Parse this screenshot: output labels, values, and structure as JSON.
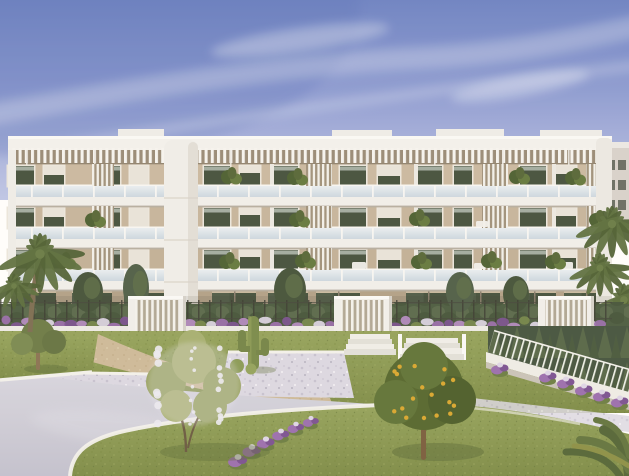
{
  "scene": {
    "type": "architectural exterior render",
    "description": "Golden-hour render of a modern four-storey apartment building with three continuous white balcony bands, glass balustrades, rooftop pergola slats, beige walls with dark glazing, vertical louvre screens and a rounded white stair tower. In front: a cypress hedge with a wire fence, three white slatted entrance gates, garden stairs, raised planters with purple flowers, terraced lawns with white kerbs, a saguaro cactus on a gravel bed, sand and pale-lavender walkways, an olive tree, a white-blossom tree, an orange tree with fruit, palm trees, a picket-railed ramp with conifers, all under a periwinkle sky with wispy clouds",
    "time_of_day": "golden hour",
    "sky": {
      "top": "#6d83c5",
      "mid": "#8d9cd4",
      "horizon": "#bfc7e8",
      "cloud": "#e9edf8"
    },
    "building": {
      "storeys": 4,
      "balcony_bands": 3,
      "entrance_gates": 3,
      "wall_color": "#c6b59e",
      "trim_color": "#f2f1ee",
      "window_glass_color": "#46523f",
      "balustrade_glass_color": "#d9e3ea",
      "pergola_shadow_color": "#998c79"
    },
    "garden": {
      "lawn_color": "#8d9c58",
      "walkway_color": "#cecdda",
      "sand_path_color": "#cdbb9b",
      "gravel_color": "#dcd9e4",
      "kerb_color": "#f3f2ee",
      "hedge_color": "#4d5d43",
      "conifer_color": "#465541",
      "flower_colors": [
        "#9b6fb0",
        "#7c5394",
        "#ded7e8"
      ],
      "orange_fruit_color": "#d9a832",
      "trees": [
        "olive tree",
        "white blossom tree",
        "orange tree",
        "palm trees"
      ],
      "features": [
        "saguaro cactus",
        "gravel bed",
        "garden stairs",
        "picket railing",
        "wire fence",
        "raised planters",
        "white kerbed lawns"
      ]
    }
  }
}
